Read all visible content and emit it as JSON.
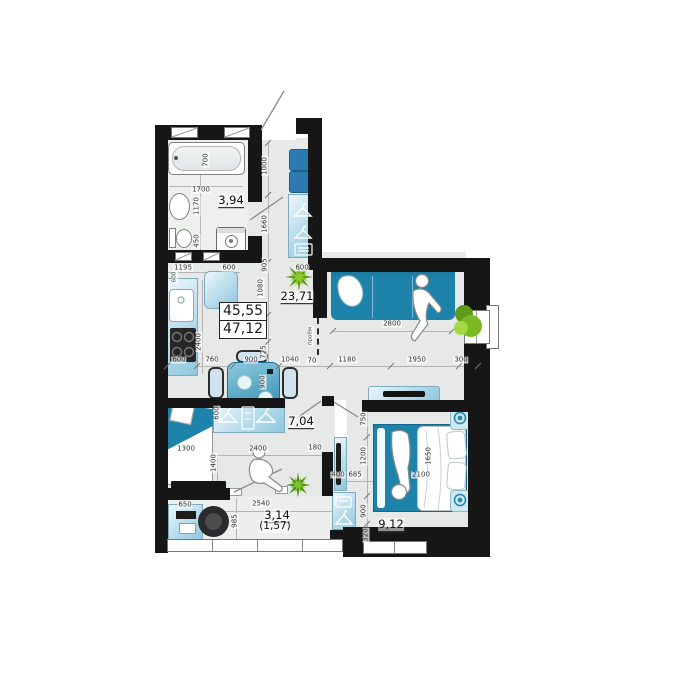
{
  "areas": {
    "total_1": "45,55",
    "total_2": "47,12",
    "bathroom": "3,94",
    "living": "23,71",
    "hall": "7,04",
    "bedroom": "9,12",
    "balcony": "3,14",
    "balcony_half": "(1,57)"
  },
  "dims": {
    "tub_width": "700",
    "tub_length": "1700",
    "bath_depth": "1170",
    "washer": "450",
    "entry_1000": "1000",
    "entry_1660": "1660",
    "entry_905": "905",
    "chain_1080": "1080",
    "chain_905": "905",
    "chain_725": "725",
    "kitchen_1195": "1195",
    "fridge_600": "600",
    "wardrobe_600": "600",
    "counter_2400": "2400",
    "counter_600": "600",
    "bottom_600": "600",
    "bottom_760": "760",
    "bottom_900": "900",
    "bottom_1040": "1040",
    "bottom_70": "70",
    "bottom_1180": "1180",
    "bottom_1950": "1950",
    "bottom_300": "300",
    "table_900": "900",
    "sofa_2800": "2800",
    "opening_label": "проём",
    "kids_1300": "1300",
    "kids_2400": "2400",
    "kids_180": "180",
    "kids_ward_600": "600",
    "kids_1400": "1400",
    "desk_650": "650",
    "balcony_985": "985",
    "balcony_2540": "2540",
    "bed_750": "750",
    "bed_1200": "1200",
    "bed_900": "900",
    "bed_320": "320",
    "bed_1650": "1650",
    "bed_2100": "2100",
    "bed_685": "685",
    "panel_400": "400"
  }
}
